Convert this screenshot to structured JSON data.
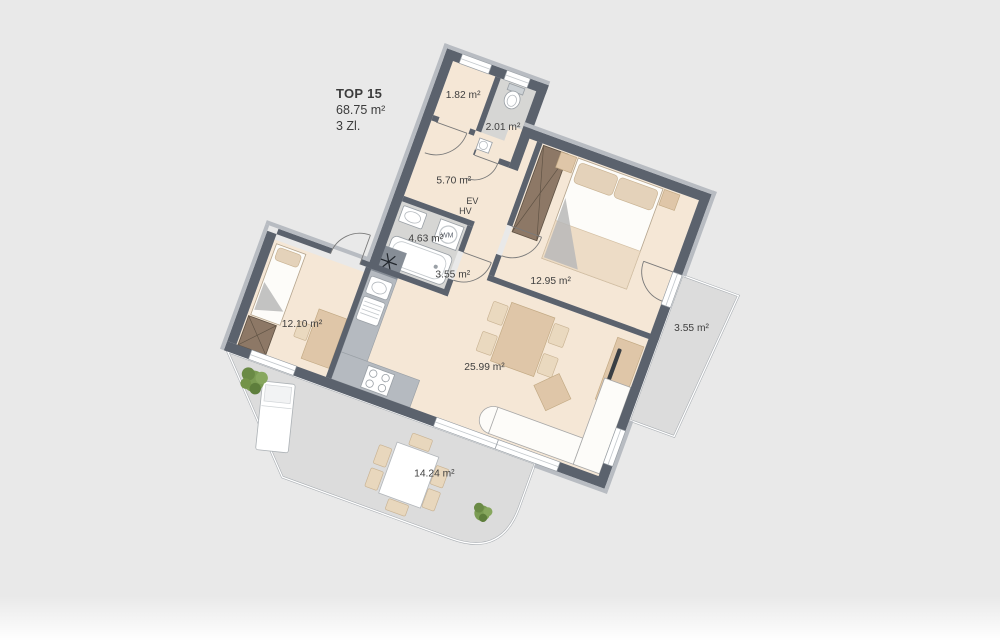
{
  "info": {
    "unit": "TOP 15",
    "area": "68.75 m²",
    "rooms": "3 Zl."
  },
  "rooms": {
    "storage": {
      "label": "1.82 m²"
    },
    "wc": {
      "label": "2.01 m²"
    },
    "hall": {
      "label": "5.70 m²"
    },
    "bath": {
      "label": "4.63 m²"
    },
    "corridor": {
      "label": "3.55 m²"
    },
    "bedroom_right": {
      "label": "12.95 m²"
    },
    "balcony": {
      "label": "3.55 m²"
    },
    "living": {
      "label": "25.99 m²"
    },
    "bedroom_left": {
      "label": "12.10 m²"
    },
    "terrace": {
      "label": "14.24 m²"
    }
  },
  "annotations": {
    "ev": "EV",
    "hv": "HV",
    "wm": "WM"
  },
  "colors": {
    "background": "#e9e9e9",
    "floor": "#f5e7d6",
    "wet_floor": "#d6d6d4",
    "outdoor_floor": "#dcdcdc",
    "wall_dark": "#5b626d",
    "wall_light": "#b8bcc2",
    "furniture_beige": "#dfc6a8",
    "furniture_light": "#ead9bf",
    "wardrobe_brown": "#8d7866",
    "plant_green": "#7b9c53"
  }
}
